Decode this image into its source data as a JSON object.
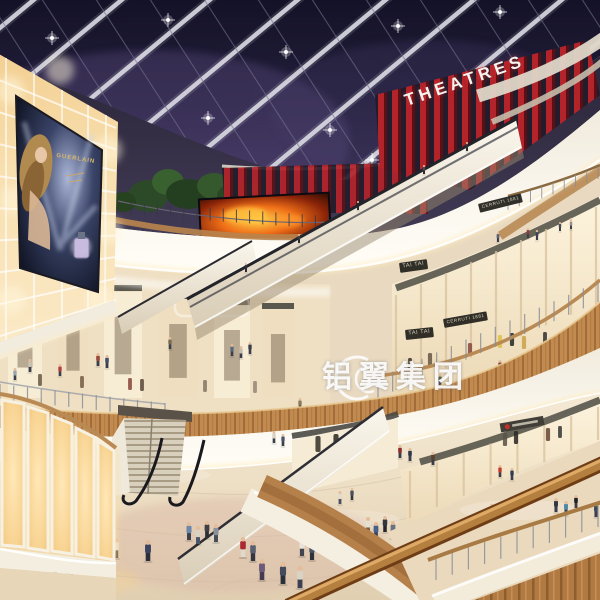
{
  "image_type": "architectural rendering - shopping mall atrium interior, evening",
  "signs": {
    "theatres": "THEATRES",
    "tai_tai_upper": "TAI TAI",
    "tai_tai_lower": "TAI TAI",
    "cerruti_upper": "CERRUTI 1881",
    "cerruti_lower": "CERRUTI 1881",
    "poster_brand": "GUERLAIN"
  },
  "watermark": {
    "text": "铝翼集团"
  },
  "colors": {
    "sky_top": "#141227",
    "sky_mid": "#2a2344",
    "sky_glow": "#6a5890",
    "beam": "#d3d3de",
    "red_slat": "#b3232a",
    "red_slat_dark": "#5c1015",
    "fascia_white": "#f6f1e6",
    "cove_glow": "#ffedc2",
    "wood": "#c08a50",
    "wood_dark": "#8f5e2e",
    "amber_wall": "#f6d79f",
    "amber_bright": "#fff0cf",
    "store_warm": "#fdf4de",
    "ground": "#efe3cd",
    "rail_wood": "#b5803f",
    "fire_orange": "#f07018"
  },
  "scene_people": {
    "ground": [
      [
        104,
        556,
        20,
        "#b5442f",
        "#e8e2d2"
      ],
      [
        116,
        558,
        20,
        "#e4dfd2",
        "#5a4a3a"
      ],
      [
        148,
        561,
        21,
        "#3c4360",
        "#2c2f3a"
      ],
      [
        189,
        540,
        18,
        "#6b88a8",
        "#3a3f4a"
      ],
      [
        198,
        544,
        18,
        "#d8d2c2",
        "#4a5568"
      ],
      [
        207,
        538,
        17,
        "#3f3f46",
        "#2a2d34"
      ],
      [
        216,
        542,
        18,
        "#8a8f99",
        "#474b55"
      ],
      [
        243,
        557,
        20,
        "#a8292f",
        "#e0dacb"
      ],
      [
        253,
        561,
        20,
        "#58606e",
        "#32363e"
      ],
      [
        302,
        556,
        19,
        "#e8e3d6",
        "#3f4550"
      ],
      [
        312,
        560,
        19,
        "#4a5568",
        "#2e323a"
      ],
      [
        368,
        534,
        17,
        "#e5e0d2",
        "#7a5c3a"
      ],
      [
        376,
        539,
        17,
        "#45608a",
        "#36425a"
      ],
      [
        385,
        532,
        16,
        "#33383f",
        "#23262c"
      ],
      [
        393,
        538,
        17,
        "#6a7280",
        "#42495a"
      ],
      [
        403,
        544,
        17,
        "#8a6a4a",
        "#3c3f4a"
      ],
      [
        558,
        541,
        18,
        "#3a3f4a",
        "#26292f"
      ],
      [
        568,
        546,
        18,
        "#4a6a8a",
        "#44566e"
      ],
      [
        578,
        538,
        17,
        "#2e3338",
        "#202327"
      ],
      [
        522,
        571,
        20,
        "#9a2d2d",
        "#e2dccd"
      ],
      [
        535,
        575,
        21,
        "#5a6a48",
        "#3a4430"
      ],
      [
        300,
        588,
        22,
        "#d9d3c4",
        "#3a4050"
      ],
      [
        283,
        584,
        22,
        "#444b5a",
        "#2b3038"
      ],
      [
        262,
        580,
        21,
        "#6e5a78",
        "#463a50"
      ],
      [
        340,
        504,
        13,
        "#e2dccc",
        "#4a5060"
      ],
      [
        352,
        500,
        12,
        "#4a5060",
        "#33383f"
      ],
      [
        30,
        540,
        18,
        "#8a4a3a",
        "#3a3430"
      ],
      [
        18,
        536,
        17,
        "#50585f",
        "#34383e"
      ],
      [
        55,
        585,
        22,
        "#3c4148",
        "#282b30"
      ],
      [
        70,
        589,
        22,
        "#6a7582",
        "#3e444e"
      ]
    ],
    "mid_walkway": [
      [
        352,
        448,
        13,
        "#b03a3a"
      ],
      [
        361,
        450,
        13,
        "#3a4458"
      ],
      [
        400,
        458,
        13,
        "#8a3030"
      ],
      [
        410,
        461,
        13,
        "#30384a"
      ],
      [
        433,
        465,
        13,
        "#58422e"
      ],
      [
        283,
        446,
        12,
        "#4a5568"
      ],
      [
        274,
        443,
        12,
        "#d8d2c2"
      ]
    ],
    "right_walkway": [
      [
        492,
        519,
        15,
        "#8a8477"
      ],
      [
        556,
        512,
        14,
        "#2e3640"
      ],
      [
        566,
        515,
        14,
        "#4a88aa"
      ],
      [
        576,
        508,
        13,
        "#1e2226"
      ],
      [
        596,
        517,
        14,
        "#3a4a5a"
      ],
      [
        500,
        477,
        12,
        "#c0392b"
      ],
      [
        512,
        480,
        12,
        "#2c3e50"
      ]
    ],
    "level3_left": [
      [
        30,
        372,
        13,
        "#c8c2b2"
      ],
      [
        98,
        366,
        13,
        "#9a4a3a"
      ],
      [
        107,
        368,
        13,
        "#44506a"
      ],
      [
        232,
        356,
        12,
        "#5a6a7a"
      ],
      [
        241,
        358,
        12,
        "#c4beae"
      ],
      [
        250,
        354,
        12,
        "#3a3f48"
      ],
      [
        170,
        349,
        12,
        "#7a6a52"
      ],
      [
        15,
        380,
        12,
        "#9aa4b0"
      ],
      [
        60,
        376,
        12,
        "#b04040"
      ]
    ],
    "level3_right": [
      [
        500,
        372,
        12,
        "#7a3030"
      ],
      [
        510,
        374,
        12,
        "#3a4456"
      ],
      [
        545,
        352,
        11,
        "#5a6478"
      ],
      [
        555,
        350,
        11,
        "#8a8478"
      ],
      [
        440,
        386,
        12,
        "#4a5a3a"
      ],
      [
        300,
        410,
        12,
        "#8a7a5a"
      ]
    ],
    "top_right": [
      [
        498,
        242,
        10,
        "#5a6474"
      ],
      [
        528,
        238,
        10,
        "#8a3a3a"
      ],
      [
        537,
        240,
        10,
        "#3c4452"
      ],
      [
        560,
        231,
        9,
        "#4a4f58"
      ],
      [
        571,
        229,
        9,
        "#99948a"
      ]
    ],
    "riders": [
      [
        246,
        272,
        9,
        "#2c3038"
      ],
      [
        299,
        243,
        9,
        "#3a3f46"
      ],
      [
        358,
        210,
        9,
        "#23262b"
      ],
      [
        424,
        174,
        9,
        "#454a52"
      ],
      [
        467,
        151,
        9,
        "#30353c"
      ]
    ],
    "theatre_level": [
      [
        470,
        162,
        9,
        "#3a3f4a"
      ],
      [
        483,
        158,
        9,
        "#56607a"
      ]
    ]
  },
  "mannequins": {
    "level3_left": [
      [
        40,
        386,
        12,
        "#6a5a48"
      ],
      [
        82,
        388,
        12,
        "#775f44"
      ],
      [
        130,
        390,
        12,
        "#8a4a3c"
      ],
      [
        142,
        391,
        12,
        "#5c4a3a"
      ],
      [
        205,
        392,
        12,
        "#887766"
      ],
      [
        255,
        393,
        12,
        "#998877"
      ]
    ],
    "level3_right": [
      [
        500,
        348,
        13,
        "#d8c14a"
      ],
      [
        512,
        346,
        13,
        "#2a2a2a"
      ],
      [
        524,
        349,
        13,
        "#caa24a"
      ],
      [
        545,
        344,
        12,
        "#333333"
      ],
      [
        558,
        347,
        12,
        "#b8893a"
      ],
      [
        470,
        356,
        13,
        "#8a4a3c"
      ],
      [
        430,
        366,
        13,
        "#6a5a48"
      ],
      [
        410,
        370,
        12,
        "#3a332c"
      ]
    ],
    "level2_center": [
      [
        318,
        452,
        16,
        "#3a332c"
      ],
      [
        336,
        450,
        16,
        "#2e2a24"
      ],
      [
        354,
        449,
        15,
        "#48413a"
      ]
    ],
    "level2_right": [
      [
        505,
        446,
        13,
        "#5c5248"
      ],
      [
        516,
        444,
        13,
        "#2e2a26"
      ],
      [
        548,
        441,
        13,
        "#6a4a3a"
      ],
      [
        560,
        438,
        12,
        "#3a3a3a"
      ]
    ]
  },
  "ceiling_lights": [
    [
      52,
      38
    ],
    [
      168,
      20
    ],
    [
      286,
      52
    ],
    [
      398,
      26
    ],
    [
      500,
      12
    ],
    [
      86,
      120
    ],
    [
      208,
      118
    ],
    [
      330,
      130
    ],
    [
      446,
      96
    ],
    [
      548,
      58
    ],
    [
      28,
      84
    ],
    [
      140,
      168
    ],
    [
      256,
      176
    ],
    [
      372,
      160
    ],
    [
      480,
      132
    ],
    [
      566,
      94
    ]
  ]
}
